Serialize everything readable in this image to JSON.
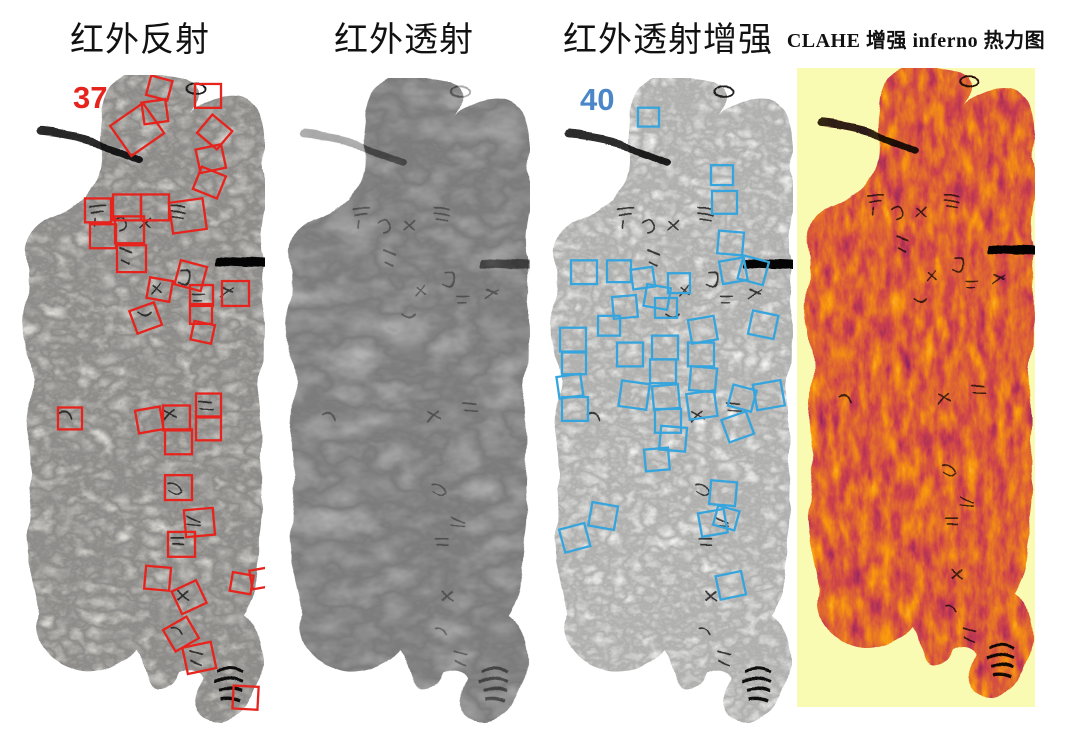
{
  "figure": {
    "background": "#ffffff",
    "description_domain": "infrared imaging comparison of inscribed tablet fragment",
    "panels": [
      {
        "name": "infrared-reflection",
        "title": "红外反射",
        "annotation_count": "37",
        "annotation_color": "#e6231d",
        "box_color": "#e6231d",
        "boxes": [
          [
            133,
            3,
            22,
            15
          ],
          [
            128,
            26,
            24,
            -8
          ],
          [
            180,
            9,
            26,
            0
          ],
          [
            103,
            36,
            40,
            -35
          ],
          [
            186,
            45,
            26,
            40
          ],
          [
            183,
            72,
            26,
            -12
          ],
          [
            181,
            96,
            26,
            22
          ],
          [
            70,
            124,
            26,
            0
          ],
          [
            98,
            120,
            28,
            0
          ],
          [
            126,
            120,
            28,
            0
          ],
          [
            156,
            126,
            34,
            -8
          ],
          [
            75,
            150,
            26,
            0
          ],
          [
            100,
            142,
            29,
            0
          ],
          [
            102,
            171,
            29,
            0
          ],
          [
            162,
            189,
            27,
            15
          ],
          [
            133,
            205,
            23,
            10
          ],
          [
            175,
            211,
            23,
            0
          ],
          [
            207,
            207,
            27,
            0
          ],
          [
            118,
            232,
            26,
            -20
          ],
          [
            175,
            230,
            22,
            0
          ],
          [
            177,
            249,
            21,
            12
          ],
          [
            43,
            334,
            24,
            0
          ],
          [
            122,
            335,
            25,
            -10
          ],
          [
            148,
            332,
            27,
            0
          ],
          [
            181,
            320,
            25,
            0
          ],
          [
            150,
            356,
            27,
            0
          ],
          [
            181,
            344,
            25,
            0
          ],
          [
            150,
            402,
            27,
            0
          ],
          [
            170,
            436,
            29,
            -5
          ],
          [
            153,
            459,
            27,
            0
          ],
          [
            130,
            494,
            25,
            5
          ],
          [
            161,
            512,
            27,
            -25
          ],
          [
            216,
            501,
            21,
            10
          ],
          [
            236,
            496,
            21,
            -10
          ],
          [
            153,
            549,
            27,
            -30
          ],
          [
            170,
            572,
            29,
            -12
          ],
          [
            218,
            614,
            25,
            3
          ]
        ]
      },
      {
        "name": "infrared-transmission",
        "title": "红外透射",
        "annotation_count": "",
        "boxes": []
      },
      {
        "name": "infrared-transmission-enhanced",
        "title": "红外透射增强",
        "annotation_count": "40",
        "annotation_color": "#4a86c8",
        "box_color": "#36a5dd",
        "boxes": [
          [
            95,
            30,
            21,
            0
          ],
          [
            168,
            88,
            22,
            0
          ],
          [
            169,
            114,
            25,
            0
          ],
          [
            175,
            155,
            25,
            5
          ],
          [
            178,
            183,
            25,
            -10
          ],
          [
            28,
            184,
            26,
            0
          ],
          [
            64,
            184,
            24,
            0
          ],
          [
            89,
            192,
            22,
            -8
          ],
          [
            125,
            197,
            22,
            0
          ],
          [
            102,
            210,
            24,
            10
          ],
          [
            70,
            220,
            24,
            -5
          ],
          [
            112,
            222,
            22,
            0
          ],
          [
            197,
            182,
            26,
            15
          ],
          [
            17,
            252,
            26,
            0
          ],
          [
            19,
            277,
            24,
            0
          ],
          [
            15,
            300,
            24,
            -8
          ],
          [
            19,
            322,
            26,
            0
          ],
          [
            55,
            240,
            22,
            0
          ],
          [
            74,
            267,
            26,
            0
          ],
          [
            77,
            307,
            28,
            8
          ],
          [
            109,
            260,
            26,
            0
          ],
          [
            107,
            284,
            26,
            0
          ],
          [
            110,
            310,
            26,
            -5
          ],
          [
            112,
            334,
            26,
            0
          ],
          [
            147,
            242,
            26,
            -10
          ],
          [
            145,
            267,
            26,
            0
          ],
          [
            147,
            292,
            26,
            5
          ],
          [
            145,
            317,
            28,
            -8
          ],
          [
            207,
            237,
            26,
            12
          ],
          [
            212,
            307,
            28,
            -10
          ],
          [
            187,
            312,
            24,
            15
          ],
          [
            182,
            340,
            26,
            -20
          ],
          [
            117,
            352,
            26,
            5
          ],
          [
            102,
            374,
            24,
            -5
          ],
          [
            47,
            430,
            26,
            10
          ],
          [
            19,
            452,
            26,
            -15
          ],
          [
            167,
            407,
            26,
            5
          ],
          [
            157,
            437,
            26,
            -10
          ],
          [
            172,
            434,
            22,
            15
          ],
          [
            175,
            500,
            26,
            -12
          ]
        ]
      },
      {
        "name": "clahe-inferno-heatmap",
        "title": "CLAHE 增强  inferno 热力图",
        "annotation_count": "",
        "background_color": "#fafbb2",
        "palette": [
          "#000004",
          "#57106e",
          "#bc3754",
          "#f98c0a",
          "#fcffa4"
        ],
        "boxes": []
      }
    ]
  }
}
